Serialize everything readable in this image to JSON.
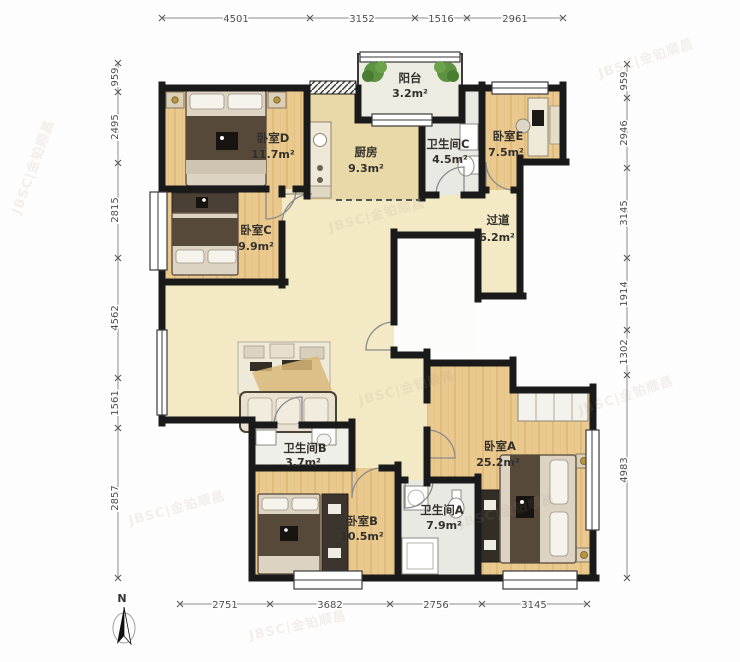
{
  "plan": {
    "rooms": [
      {
        "id": "balcony",
        "name": "阳台",
        "area": "3.2m²"
      },
      {
        "id": "bedroom-d",
        "name": "卧室D",
        "area": "11.7m²"
      },
      {
        "id": "kitchen",
        "name": "厨房",
        "area": "9.3m²"
      },
      {
        "id": "bath-c",
        "name": "卫生间C",
        "area": "4.5m²"
      },
      {
        "id": "bedroom-e",
        "name": "卧室E",
        "area": "7.5m²"
      },
      {
        "id": "hallway",
        "name": "过道",
        "area": "6.2m²"
      },
      {
        "id": "bedroom-c",
        "name": "卧室C",
        "area": "9.9m²"
      },
      {
        "id": "bath-b",
        "name": "卫生间B",
        "area": "3.7m²"
      },
      {
        "id": "bedroom-b",
        "name": "卧室B",
        "area": "10.5m²"
      },
      {
        "id": "bath-a",
        "name": "卫生间A",
        "area": "7.9m²"
      },
      {
        "id": "bedroom-a",
        "name": "卧室A",
        "area": "25.2m²"
      }
    ],
    "dimensions": {
      "top": [
        "4501",
        "3152",
        "1516",
        "2961"
      ],
      "bottom": [
        "2751",
        "3682",
        "2756",
        "3145"
      ],
      "left": [
        "959",
        "2495",
        "2815",
        "4562",
        "1561",
        "2857"
      ],
      "right": [
        "959",
        "2946",
        "3145",
        "1914",
        "1302",
        "4983"
      ]
    },
    "compass": "N",
    "watermark": "JBSC|金铂顺昌",
    "colors": {
      "wall": "#1a1a1a",
      "wood_floor": "#eac98e",
      "beige_floor": "#f3e9c5",
      "kitchen_floor": "#ead9a8",
      "tile_floor": "#e9e9e3",
      "accent_gold": "#b8963e",
      "plant_green": "#55862f",
      "dark_throw": "#57493a"
    }
  }
}
